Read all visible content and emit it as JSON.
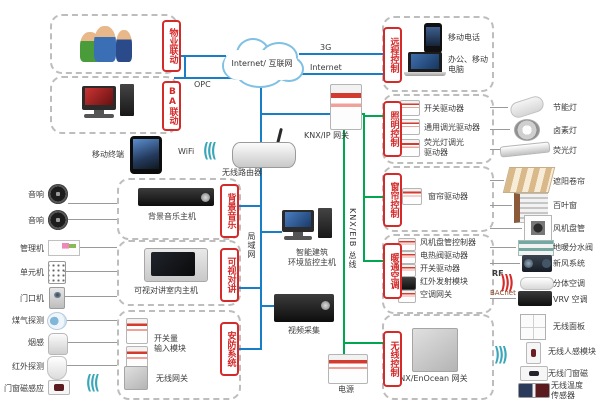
{
  "colors": {
    "line_blue": "#1a7ec6",
    "line_green": "#00a650",
    "tag_red": "#d42a2a",
    "box_dash": "#bdbdbd"
  },
  "top": {
    "cloud": "Internet/ 互联网",
    "g3": "3G",
    "internet": "Internet",
    "opc": "OPC"
  },
  "tags": {
    "property": "物业联动",
    "ba": "BA联动",
    "remote": "远程控制",
    "music": "背景音乐",
    "intercom": "可视对讲",
    "security": "安防系统",
    "lighting": "照明控制",
    "curtain": "窗帘控制",
    "hvac": "暖通空调",
    "wireless": "无线控制"
  },
  "center": {
    "router": "无线路由器",
    "knx_ip_gw": "KNX/IP 网关",
    "mobile": "移动终端",
    "wifi": "WiFi",
    "lan": "局域网",
    "host": "智能建筑\n环境监控主机",
    "video": "视频采集",
    "bus": "KNX/EIB 总线",
    "power": "电源",
    "enocean_gw": "KNX/EnOcean 网关",
    "rf": "RF",
    "bacnet": "BACnet"
  },
  "remote_items": [
    {
      "label": "移动电话"
    },
    {
      "label": "办公、移动\n电脑"
    }
  ],
  "music_device": "背景音乐主机",
  "intercom_device": "可视对讲室内主机",
  "security_items": {
    "input": "开关量\n输入模块",
    "gw": "无线网关"
  },
  "lighting_modules": [
    "开关驱动器",
    "通用调光驱动器",
    "荧光灯调光\n驱动器"
  ],
  "curtain_modules": [
    "窗帘驱动器"
  ],
  "hvac_modules": [
    "风机盘管控制器",
    "电热阀驱动器",
    "开关驱动器",
    "红外发射模块",
    "空调网关"
  ],
  "left_items": [
    {
      "label": "音响"
    },
    {
      "label": "音响"
    },
    {
      "label": "管理机"
    },
    {
      "label": "单元机"
    },
    {
      "label": "门口机"
    },
    {
      "label": "煤气探测"
    },
    {
      "label": "烟感"
    },
    {
      "label": "红外探测"
    },
    {
      "label": "门窗磁感应"
    }
  ],
  "right_items": {
    "lighting": [
      "节能灯",
      "卤素灯",
      "荧光灯"
    ],
    "curtain": [
      "遮阳卷帘",
      "百叶窗"
    ],
    "hvac": [
      "风机盘管",
      "地暖分水阀",
      "新风系统",
      "分体空调",
      "VRV 空调"
    ],
    "wireless": [
      "无线面板",
      "无线人感模块",
      "无线门窗磁",
      "无线温度\n传感器"
    ]
  }
}
